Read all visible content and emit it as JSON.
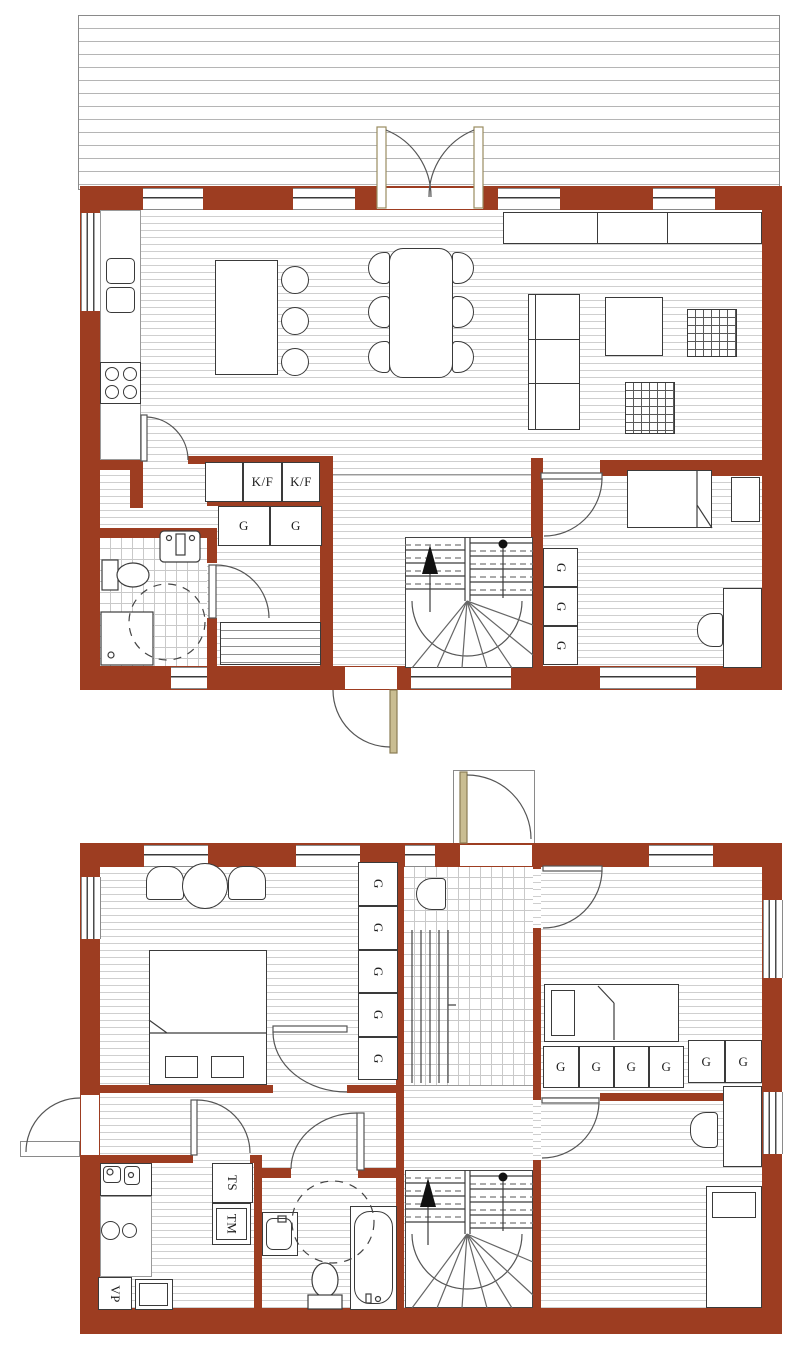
{
  "colors": {
    "wall_brick": "#9d3d21",
    "floor_line": "#cfcfcf",
    "outline": "#3a3a3a"
  },
  "ground_floor": {
    "fridge_freezer_units": [
      "K/F",
      "K/F"
    ],
    "hall_wardrobes": [
      "G",
      "G"
    ],
    "bedroom_wardrobes": [
      "G",
      "G",
      "G"
    ]
  },
  "upper_floor": {
    "master_wardrobes": [
      "G",
      "G",
      "G",
      "G",
      "G"
    ],
    "bedroom_wardrobes_row": [
      "G",
      "G",
      "G",
      "G"
    ],
    "bedroom_wardrobes_pair": [
      "G",
      "G"
    ],
    "drying_cabinet": "TS",
    "washing_machine": "TM",
    "heat_pump": "VP"
  }
}
